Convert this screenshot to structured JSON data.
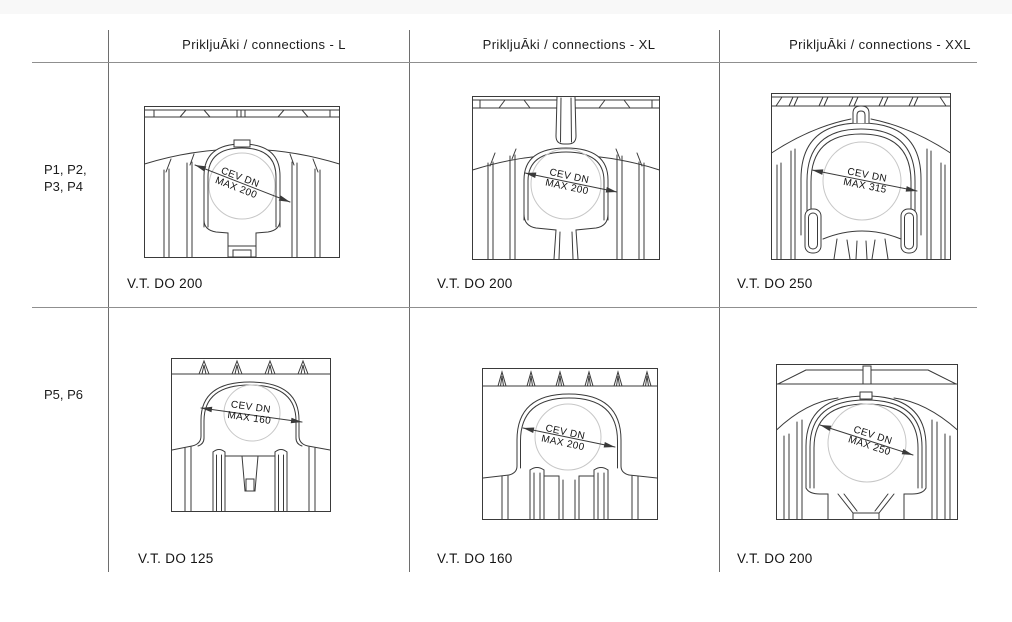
{
  "columns": [
    {
      "header": "PrikljuĀki / connections - L"
    },
    {
      "header": "PrikljuĀki / connections - XL"
    },
    {
      "header": "PrikljuĀki / connections - XXL"
    }
  ],
  "row_groups": [
    {
      "lines": [
        "P1, P2,",
        "P3, P4"
      ]
    },
    {
      "lines": [
        "P5, P6"
      ]
    }
  ],
  "cells": [
    {
      "dim_line1": "CEV DN",
      "dim_line2": "MAX 200",
      "vt_label": "V.T. DO 200"
    },
    {
      "dim_line1": "CEV DN",
      "dim_line2": "MAX 200",
      "vt_label": "V.T. DO 200"
    },
    {
      "dim_line1": "CEV DN",
      "dim_line2": "MAX 315",
      "vt_label": "V.T. DO 250"
    },
    {
      "dim_line1": "CEV DN",
      "dim_line2": "MAX 160",
      "vt_label": "V.T. DO 125"
    },
    {
      "dim_line1": "CEV DN",
      "dim_line2": "MAX 200",
      "vt_label": "V.T. DO 160"
    },
    {
      "dim_line1": "CEV DN",
      "dim_line2": "MAX 250",
      "vt_label": "V.T. DO 200"
    }
  ],
  "colors": {
    "grid_line": "#6e6e6e",
    "drawing_stroke": "#3a3a3a",
    "pipe_circle": "#c7c7c7",
    "top_strip": "#f8f8f8"
  }
}
